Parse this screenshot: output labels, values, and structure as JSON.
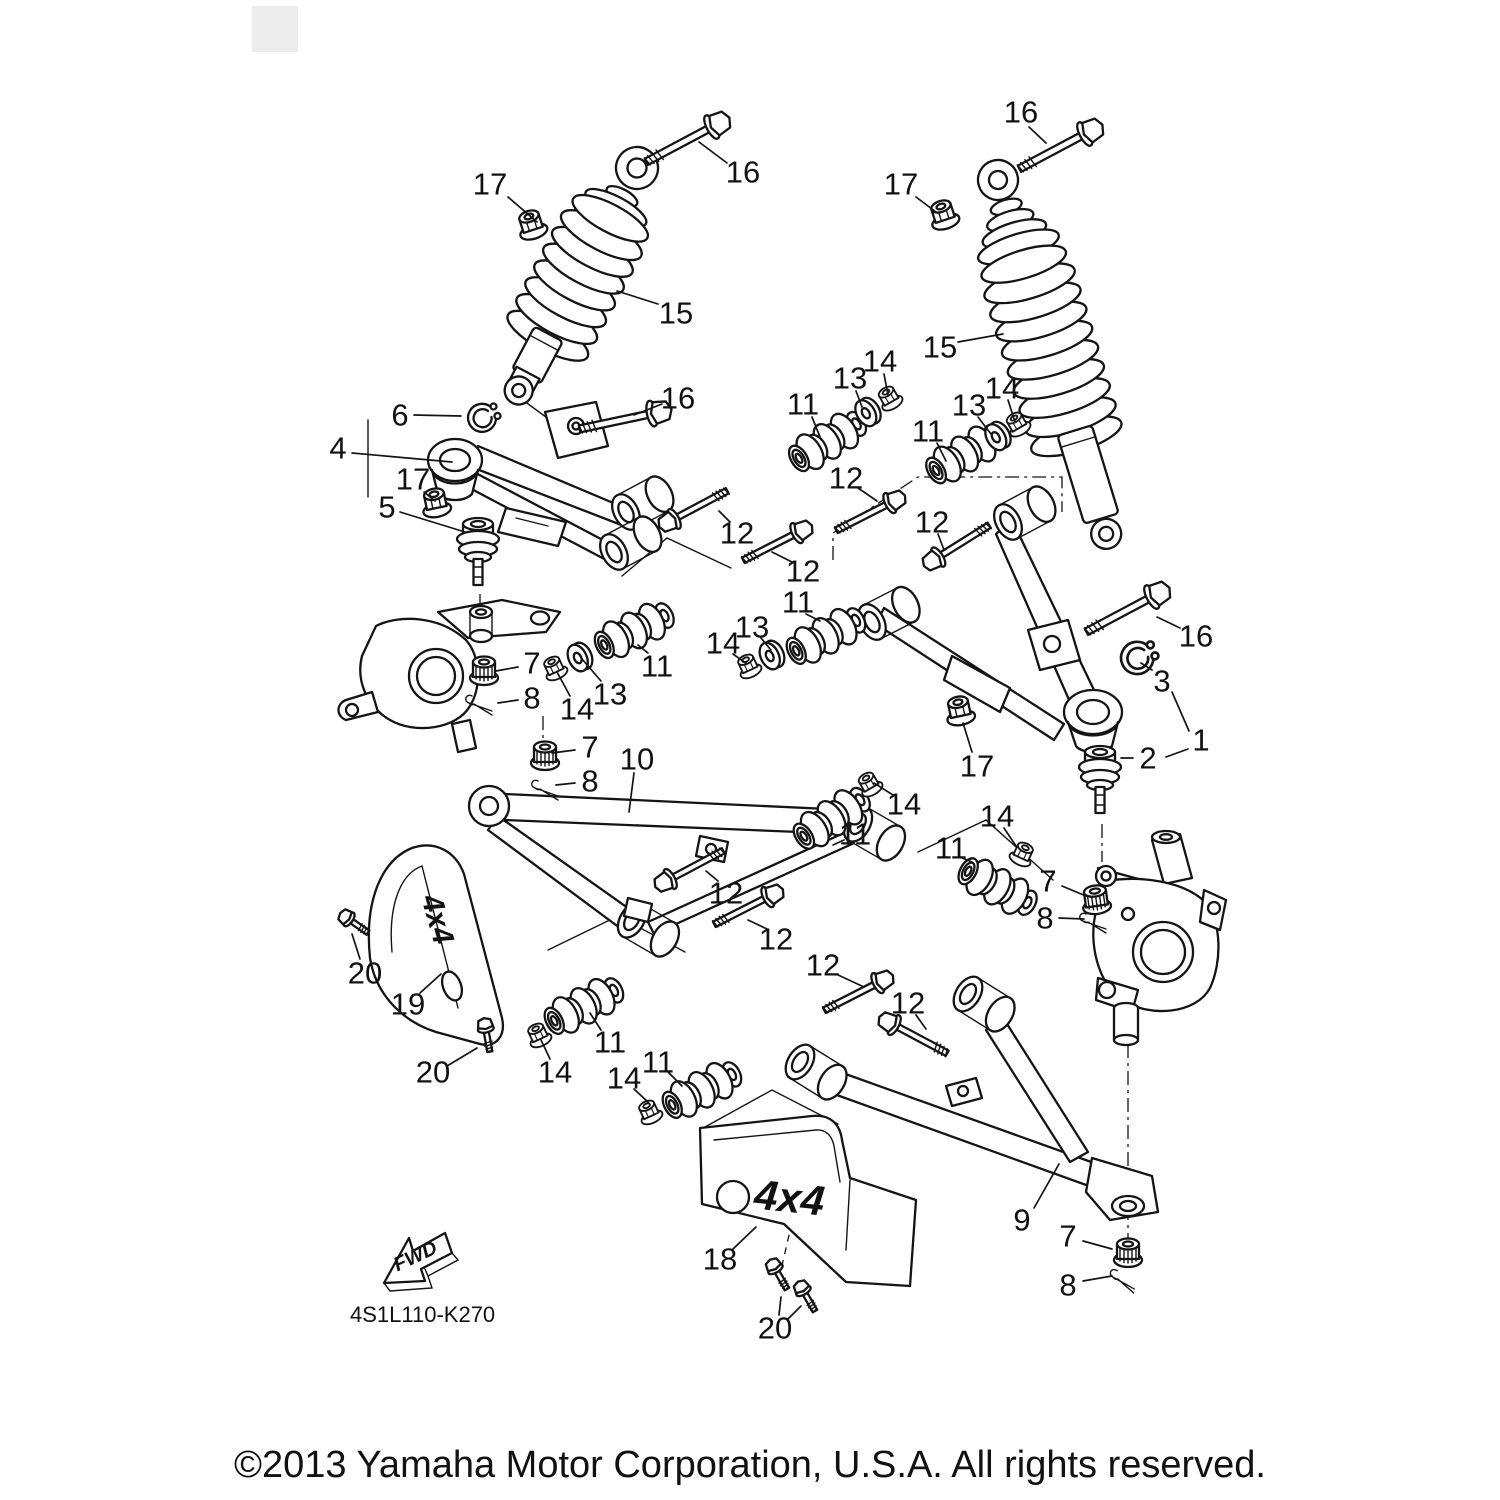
{
  "diagram": {
    "part_code": "4S1L110-K270",
    "fwd_label": "FWD",
    "guard_left_label": "4x4",
    "guard_right_label": "4x4",
    "line_color": "#141414",
    "background_color": "#ffffff"
  },
  "footer": {
    "copyright": "©2013 Yamaha Motor Corporation, U.S.A. All rights reserved."
  },
  "callouts": [
    {
      "n": "17",
      "x": 490,
      "y": 184,
      "l": [
        [
          [
            508,
            197
          ],
          [
            537,
            222
          ]
        ]
      ]
    },
    {
      "n": "16",
      "x": 743,
      "y": 172,
      "l": [
        [
          [
            727,
            163
          ],
          [
            699,
            142
          ]
        ]
      ]
    },
    {
      "n": "15",
      "x": 676,
      "y": 313,
      "l": [
        [
          [
            658,
            304
          ],
          [
            617,
            291
          ]
        ]
      ]
    },
    {
      "n": "16",
      "x": 1021,
      "y": 112,
      "l": [
        [
          [
            1029,
            127
          ],
          [
            1046,
            143
          ]
        ]
      ]
    },
    {
      "n": "17",
      "x": 901,
      "y": 184,
      "l": [
        [
          [
            916,
            197
          ],
          [
            936,
            212
          ]
        ]
      ]
    },
    {
      "n": "15",
      "x": 940,
      "y": 347,
      "l": [
        [
          [
            958,
            342
          ],
          [
            1003,
            334
          ]
        ]
      ]
    },
    {
      "n": "6",
      "x": 400,
      "y": 415,
      "l": [
        [
          [
            414,
            415
          ],
          [
            461,
            416
          ]
        ]
      ]
    },
    {
      "n": "4",
      "x": 338,
      "y": 448,
      "l": [
        [
          [
            352,
            453
          ],
          [
            452,
            462
          ]
        ]
      ]
    },
    {
      "n": "17",
      "x": 413,
      "y": 479,
      "l": [
        [
          [
            424,
            492
          ],
          [
            435,
            501
          ]
        ]
      ]
    },
    {
      "n": "5",
      "x": 387,
      "y": 507,
      "l": [
        [
          [
            400,
            512
          ],
          [
            465,
            532
          ]
        ]
      ]
    },
    {
      "n": "16",
      "x": 678,
      "y": 398,
      "l": [
        [
          [
            662,
            404
          ],
          [
            634,
            415
          ]
        ]
      ]
    },
    {
      "n": "11",
      "x": 803,
      "y": 404,
      "l": [
        [
          [
            812,
            417
          ],
          [
            820,
            437
          ]
        ]
      ]
    },
    {
      "n": "13",
      "x": 850,
      "y": 378,
      "l": [
        [
          [
            856,
            391
          ],
          [
            862,
            407
          ]
        ]
      ]
    },
    {
      "n": "14",
      "x": 880,
      "y": 361,
      "l": [
        [
          [
            884,
            374
          ],
          [
            888,
            395
          ]
        ]
      ]
    },
    {
      "n": "11",
      "x": 928,
      "y": 431,
      "l": [
        [
          [
            937,
            443
          ],
          [
            946,
            461
          ]
        ]
      ]
    },
    {
      "n": "13",
      "x": 969,
      "y": 405,
      "l": [
        [
          [
            978,
            417
          ],
          [
            991,
            434
          ]
        ]
      ]
    },
    {
      "n": "14",
      "x": 1002,
      "y": 388,
      "l": [
        [
          [
            1008,
            400
          ],
          [
            1015,
            422
          ]
        ]
      ]
    },
    {
      "n": "12",
      "x": 846,
      "y": 478,
      "l": [
        [
          [
            858,
            488
          ],
          [
            877,
            501
          ]
        ]
      ]
    },
    {
      "n": "12",
      "x": 932,
      "y": 522,
      "l": [
        [
          [
            938,
            534
          ],
          [
            944,
            550
          ]
        ]
      ]
    },
    {
      "n": "12",
      "x": 737,
      "y": 533,
      "l": [
        [
          [
            730,
            522
          ],
          [
            719,
            511
          ]
        ]
      ]
    },
    {
      "n": "12",
      "x": 803,
      "y": 571,
      "l": [
        [
          [
            792,
            562
          ],
          [
            772,
            552
          ]
        ]
      ]
    },
    {
      "n": "16",
      "x": 1196,
      "y": 636,
      "l": [
        [
          [
            1180,
            628
          ],
          [
            1157,
            617
          ]
        ]
      ]
    },
    {
      "n": "3",
      "x": 1162,
      "y": 681,
      "l": [
        [
          [
            1152,
            670
          ],
          [
            1141,
            663
          ]
        ]
      ]
    },
    {
      "n": "1",
      "x": 1201,
      "y": 740,
      "l": [
        [
          [
            1189,
            731
          ],
          [
            1172,
            692
          ]
        ],
        [
          [
            1188,
            749
          ],
          [
            1166,
            757
          ]
        ]
      ]
    },
    {
      "n": "2",
      "x": 1148,
      "y": 758,
      "l": [
        [
          [
            1133,
            758
          ],
          [
            1121,
            758
          ]
        ]
      ]
    },
    {
      "n": "17",
      "x": 977,
      "y": 766,
      "l": [
        [
          [
            972,
            752
          ],
          [
            963,
            723
          ]
        ]
      ]
    },
    {
      "n": "7",
      "x": 532,
      "y": 663,
      "l": [
        [
          [
            518,
            667
          ],
          [
            496,
            671
          ]
        ]
      ]
    },
    {
      "n": "8",
      "x": 532,
      "y": 698,
      "l": [
        [
          [
            518,
            700
          ],
          [
            498,
            703
          ]
        ]
      ]
    },
    {
      "n": "14",
      "x": 577,
      "y": 709,
      "l": [
        [
          [
            570,
            696
          ],
          [
            557,
            672
          ]
        ]
      ]
    },
    {
      "n": "13",
      "x": 610,
      "y": 694,
      "l": [
        [
          [
            601,
            681
          ],
          [
            582,
            659
          ]
        ]
      ]
    },
    {
      "n": "11",
      "x": 657,
      "y": 666,
      "l": [
        [
          [
            648,
            653
          ],
          [
            638,
            645
          ]
        ]
      ]
    },
    {
      "n": "11",
      "x": 798,
      "y": 602,
      "l": [
        [
          [
            806,
            614
          ],
          [
            820,
            621
          ]
        ]
      ]
    },
    {
      "n": "13",
      "x": 752,
      "y": 627,
      "l": [
        [
          [
            761,
            638
          ],
          [
            771,
            650
          ]
        ]
      ]
    },
    {
      "n": "14",
      "x": 723,
      "y": 643,
      "l": [
        [
          [
            733,
            654
          ],
          [
            747,
            664
          ]
        ]
      ]
    },
    {
      "n": "7",
      "x": 590,
      "y": 747,
      "l": [
        [
          [
            575,
            750
          ],
          [
            552,
            753
          ]
        ]
      ]
    },
    {
      "n": "8",
      "x": 590,
      "y": 781,
      "l": [
        [
          [
            575,
            783
          ],
          [
            556,
            785
          ]
        ]
      ]
    },
    {
      "n": "10",
      "x": 637,
      "y": 759,
      "l": [
        [
          [
            634,
            773
          ],
          [
            629,
            812
          ]
        ]
      ]
    },
    {
      "n": "14",
      "x": 904,
      "y": 804,
      "l": [
        [
          [
            893,
            795
          ],
          [
            874,
            783
          ]
        ]
      ]
    },
    {
      "n": "11",
      "x": 855,
      "y": 834,
      "l": [
        [
          [
            844,
            840
          ],
          [
            833,
            845
          ]
        ]
      ]
    },
    {
      "n": "14",
      "x": 997,
      "y": 816,
      "l": [
        [
          [
            1004,
            828
          ],
          [
            1016,
            846
          ]
        ]
      ]
    },
    {
      "n": "11",
      "x": 951,
      "y": 848,
      "l": [
        [
          [
            960,
            857
          ],
          [
            972,
            862
          ]
        ]
      ]
    },
    {
      "n": "7",
      "x": 1048,
      "y": 881,
      "l": [
        [
          [
            1062,
            886
          ],
          [
            1086,
            896
          ]
        ]
      ]
    },
    {
      "n": "8",
      "x": 1045,
      "y": 918,
      "l": [
        [
          [
            1059,
            918
          ],
          [
            1084,
            919
          ]
        ]
      ]
    },
    {
      "n": "12",
      "x": 726,
      "y": 893,
      "l": [
        [
          [
            718,
            881
          ],
          [
            706,
            871
          ]
        ]
      ]
    },
    {
      "n": "12",
      "x": 776,
      "y": 939,
      "l": [
        [
          [
            767,
            929
          ],
          [
            748,
            920
          ]
        ]
      ]
    },
    {
      "n": "12",
      "x": 823,
      "y": 965,
      "l": [
        [
          [
            836,
            974
          ],
          [
            864,
            987
          ]
        ]
      ]
    },
    {
      "n": "12",
      "x": 908,
      "y": 1003,
      "l": [
        [
          [
            916,
            1015
          ],
          [
            926,
            1029
          ]
        ]
      ]
    },
    {
      "n": "20",
      "x": 365,
      "y": 973,
      "l": [
        [
          [
            360,
            959
          ],
          [
            352,
            934
          ]
        ]
      ]
    },
    {
      "n": "19",
      "x": 408,
      "y": 1004,
      "l": [
        [
          [
            420,
            993
          ],
          [
            441,
            974
          ]
        ]
      ]
    },
    {
      "n": "20",
      "x": 433,
      "y": 1072,
      "l": [
        [
          [
            447,
            1066
          ],
          [
            477,
            1048
          ]
        ]
      ]
    },
    {
      "n": "14",
      "x": 555,
      "y": 1072,
      "l": [
        [
          [
            550,
            1059
          ],
          [
            541,
            1040
          ]
        ]
      ]
    },
    {
      "n": "11",
      "x": 610,
      "y": 1042,
      "l": [
        [
          [
            601,
            1030
          ],
          [
            590,
            1013
          ]
        ]
      ]
    },
    {
      "n": "14",
      "x": 624,
      "y": 1078,
      "l": [
        [
          [
            634,
            1089
          ],
          [
            648,
            1102
          ]
        ]
      ]
    },
    {
      "n": "11",
      "x": 658,
      "y": 1062,
      "l": [
        [
          [
            668,
            1072
          ],
          [
            682,
            1086
          ]
        ]
      ]
    },
    {
      "n": "18",
      "x": 720,
      "y": 1259,
      "l": [
        [
          [
            733,
            1249
          ],
          [
            756,
            1227
          ]
        ]
      ]
    },
    {
      "n": "9",
      "x": 1022,
      "y": 1220,
      "l": [
        [
          [
            1034,
            1208
          ],
          [
            1059,
            1164
          ]
        ]
      ]
    },
    {
      "n": "7",
      "x": 1068,
      "y": 1236,
      "l": [
        [
          [
            1083,
            1241
          ],
          [
            1112,
            1249
          ]
        ]
      ]
    },
    {
      "n": "8",
      "x": 1068,
      "y": 1285,
      "l": [
        [
          [
            1083,
            1281
          ],
          [
            1112,
            1276
          ]
        ]
      ]
    },
    {
      "n": "20",
      "x": 775,
      "y": 1328,
      "l": [
        [
          [
            779,
            1315
          ],
          [
            781,
            1297
          ]
        ],
        [
          [
            788,
            1319
          ],
          [
            801,
            1306
          ]
        ]
      ]
    }
  ]
}
